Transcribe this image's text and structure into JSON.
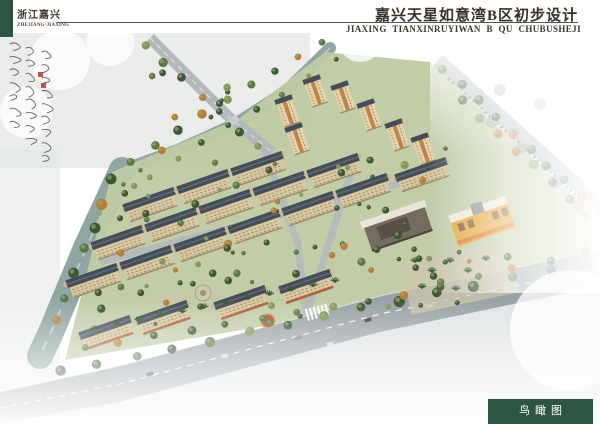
{
  "header": {
    "region_cn": "浙江嘉兴",
    "region_en": "ZHEJIANG·JIAXING",
    "title_cn": "嘉兴天星如意湾B区初步设计",
    "title_en": "JIAXING TIANXINRUYIWAN B QU CHUBUSHEJI"
  },
  "footer": {
    "label_cn": "鸟瞰图"
  },
  "colors": {
    "accent_green": "#2d5642",
    "rule": "#4a5a50",
    "water": "#8fa6a2",
    "water_streak": "#c6d4d1",
    "site": "#bfcaa3",
    "road": "#9aa2a6",
    "road_light": "#b3b9bb",
    "sidewalk": "#c9cdce",
    "roof": "#454e58",
    "roof_light": "#606a74",
    "facade": "#d8c7a0",
    "facade_shadow": "#9b8e6a",
    "gable": "#c9bb94",
    "window_line": "#8a7c58",
    "tower_facade": "#e3d2ab",
    "tower_accent": "#c08448",
    "tree_dark": "#3c5733",
    "tree_mid": "#5b7844",
    "tree_light": "#83975a",
    "tree_autumn": "#bb7c33",
    "mist_gray": "#e3e7e3",
    "mist_tree": "#9aa89a",
    "plaza": "#cdc5ae",
    "plaza_ring": "#a9a188",
    "plaza_core": "#8fa06a",
    "red_plaza": "#b65038",
    "red_ring": "#d9a05a",
    "awning_red": "#b8512f",
    "kg_yellow": "#e6a83e",
    "kg_orange": "#d77f2e",
    "kg_roof": "#efe8d6",
    "commercial_wall": "#756c60",
    "commercial_dark": "#57504a",
    "commercial_roof": "#e9e5da",
    "car_dark": "#3a3f44",
    "car_light": "#d8dadc",
    "car_mid": "#7d8488",
    "ink": "#4a4a46",
    "seal_red": "#b03a2e"
  },
  "scene": {
    "canal": [
      [
        330,
        48
      ],
      [
        285,
        92
      ],
      [
        235,
        124
      ],
      [
        178,
        150
      ],
      [
        122,
        170
      ]
    ],
    "river": [
      [
        122,
        170
      ],
      [
        86,
        248
      ],
      [
        52,
        330
      ],
      [
        40,
        356
      ]
    ],
    "site": [
      [
        325,
        52
      ],
      [
        430,
        62
      ],
      [
        592,
        212
      ],
      [
        592,
        252
      ],
      [
        312,
        318
      ],
      [
        65,
        360
      ],
      [
        112,
        172
      ],
      [
        240,
        118
      ]
    ],
    "road_main_top": [
      [
        0,
        392
      ],
      [
        120,
        366
      ],
      [
        380,
        296
      ],
      [
        600,
        250
      ]
    ],
    "road_main_bot": [
      [
        600,
        286
      ],
      [
        380,
        332
      ],
      [
        120,
        402
      ],
      [
        0,
        424
      ]
    ],
    "road_main_mid": [
      [
        0,
        408
      ],
      [
        120,
        384
      ],
      [
        380,
        314
      ],
      [
        600,
        268
      ]
    ],
    "road_tl": [
      [
        150,
        38
      ],
      [
        230,
        118
      ],
      [
        272,
        152
      ]
    ],
    "road_right": [
      [
        438,
        60
      ],
      [
        600,
        206
      ]
    ],
    "roads_internal": [
      [
        [
          305,
          320
        ],
        [
          338,
          214
        ],
        [
          352,
          170
        ]
      ],
      [
        [
          264,
          150
        ],
        [
          298,
          244
        ],
        [
          306,
          318
        ]
      ],
      [
        [
          100,
          262
        ],
        [
          430,
          176
        ]
      ]
    ],
    "towers": [
      [
        290,
        118
      ],
      [
        318,
        98
      ],
      [
        346,
        104
      ],
      [
        372,
        122
      ],
      [
        300,
        146
      ],
      [
        400,
        142
      ],
      [
        426,
        156
      ]
    ],
    "slabs": [
      [
        152,
        208
      ],
      [
        206,
        190
      ],
      [
        260,
        172
      ],
      [
        120,
        246
      ],
      [
        174,
        228
      ],
      [
        228,
        210
      ],
      [
        282,
        192
      ],
      [
        336,
        174
      ],
      [
        95,
        284
      ],
      [
        149,
        266
      ],
      [
        203,
        248
      ],
      [
        257,
        230
      ],
      [
        311,
        212
      ],
      [
        365,
        194
      ],
      [
        424,
        178
      ]
    ],
    "street_slabs": [
      [
        108,
        336
      ],
      [
        165,
        321
      ],
      [
        243,
        306
      ],
      [
        308,
        290
      ]
    ],
    "commercial": [
      398,
      228
    ],
    "kindergarten": [
      482,
      222
    ],
    "plazas": [
      [
        203,
        293
      ],
      [
        258,
        296
      ]
    ],
    "red_plaza": [
      268,
      321
    ],
    "treelines": [
      {
        "from": [
          322,
          42
        ],
        "to": [
          132,
          160
        ],
        "n": 9,
        "r": 4
      },
      {
        "from": [
          336,
          60
        ],
        "to": [
          150,
          176
        ],
        "n": 8,
        "r": 3
      },
      {
        "from": [
          112,
          180
        ],
        "to": [
          56,
          320
        ],
        "n": 7,
        "r": 5
      },
      {
        "from": [
          146,
          44
        ],
        "to": [
          258,
          148
        ],
        "n": 7,
        "r": 4
      },
      {
        "from": [
          444,
          70
        ],
        "to": [
          600,
          212
        ],
        "n": 10,
        "r": 5
      },
      {
        "from": [
          462,
          100
        ],
        "to": [
          588,
          216
        ],
        "n": 8,
        "r": 4
      },
      {
        "from": [
          60,
          372
        ],
        "to": [
          588,
          262
        ],
        "n": 15,
        "r": 5
      },
      {
        "from": [
          84,
          348
        ],
        "to": [
          332,
          306
        ],
        "n": 8,
        "r": 4
      },
      {
        "from": [
          368,
          302
        ],
        "to": [
          586,
          252
        ],
        "n": 7,
        "r": 4
      }
    ],
    "tree_clusters": [
      {
        "x": 120,
        "y": 150,
        "w": 250,
        "h": 140,
        "n": 34
      },
      {
        "x": 92,
        "y": 252,
        "w": 215,
        "h": 72,
        "n": 20
      },
      {
        "x": 330,
        "y": 148,
        "w": 118,
        "h": 116,
        "n": 18
      },
      {
        "x": 352,
        "y": 252,
        "w": 160,
        "h": 58,
        "n": 12
      },
      {
        "x": 150,
        "y": 52,
        "w": 90,
        "h": 70,
        "n": 8
      }
    ],
    "mist_trees": [
      [
        492,
        122
      ],
      [
        522,
        148
      ],
      [
        556,
        182
      ],
      [
        578,
        206
      ],
      [
        540,
        104
      ],
      [
        500,
        90
      ]
    ],
    "palm_line": {
      "from": [
        95,
        330
      ],
      "to": [
        335,
        282
      ],
      "n": 12
    },
    "plaza_palms": [
      [
        415,
        262
      ],
      [
        432,
        272
      ],
      [
        450,
        262
      ],
      [
        468,
        272
      ],
      [
        486,
        260
      ],
      [
        422,
        288
      ],
      [
        456,
        290
      ]
    ],
    "cars_main": [
      [
        150,
        374
      ],
      [
        225,
        356
      ],
      [
        298,
        338
      ],
      [
        368,
        320
      ],
      [
        430,
        306
      ],
      [
        500,
        290
      ],
      [
        552,
        276
      ],
      [
        330,
        344
      ]
    ],
    "zebra": [
      318,
      312
    ],
    "flags": [
      [
        296,
        292
      ],
      [
        302,
        290
      ],
      [
        308,
        288
      ]
    ],
    "bridge": [
      233,
      121
    ],
    "seals": [
      [
        38,
        72
      ],
      [
        41,
        83
      ]
    ]
  }
}
